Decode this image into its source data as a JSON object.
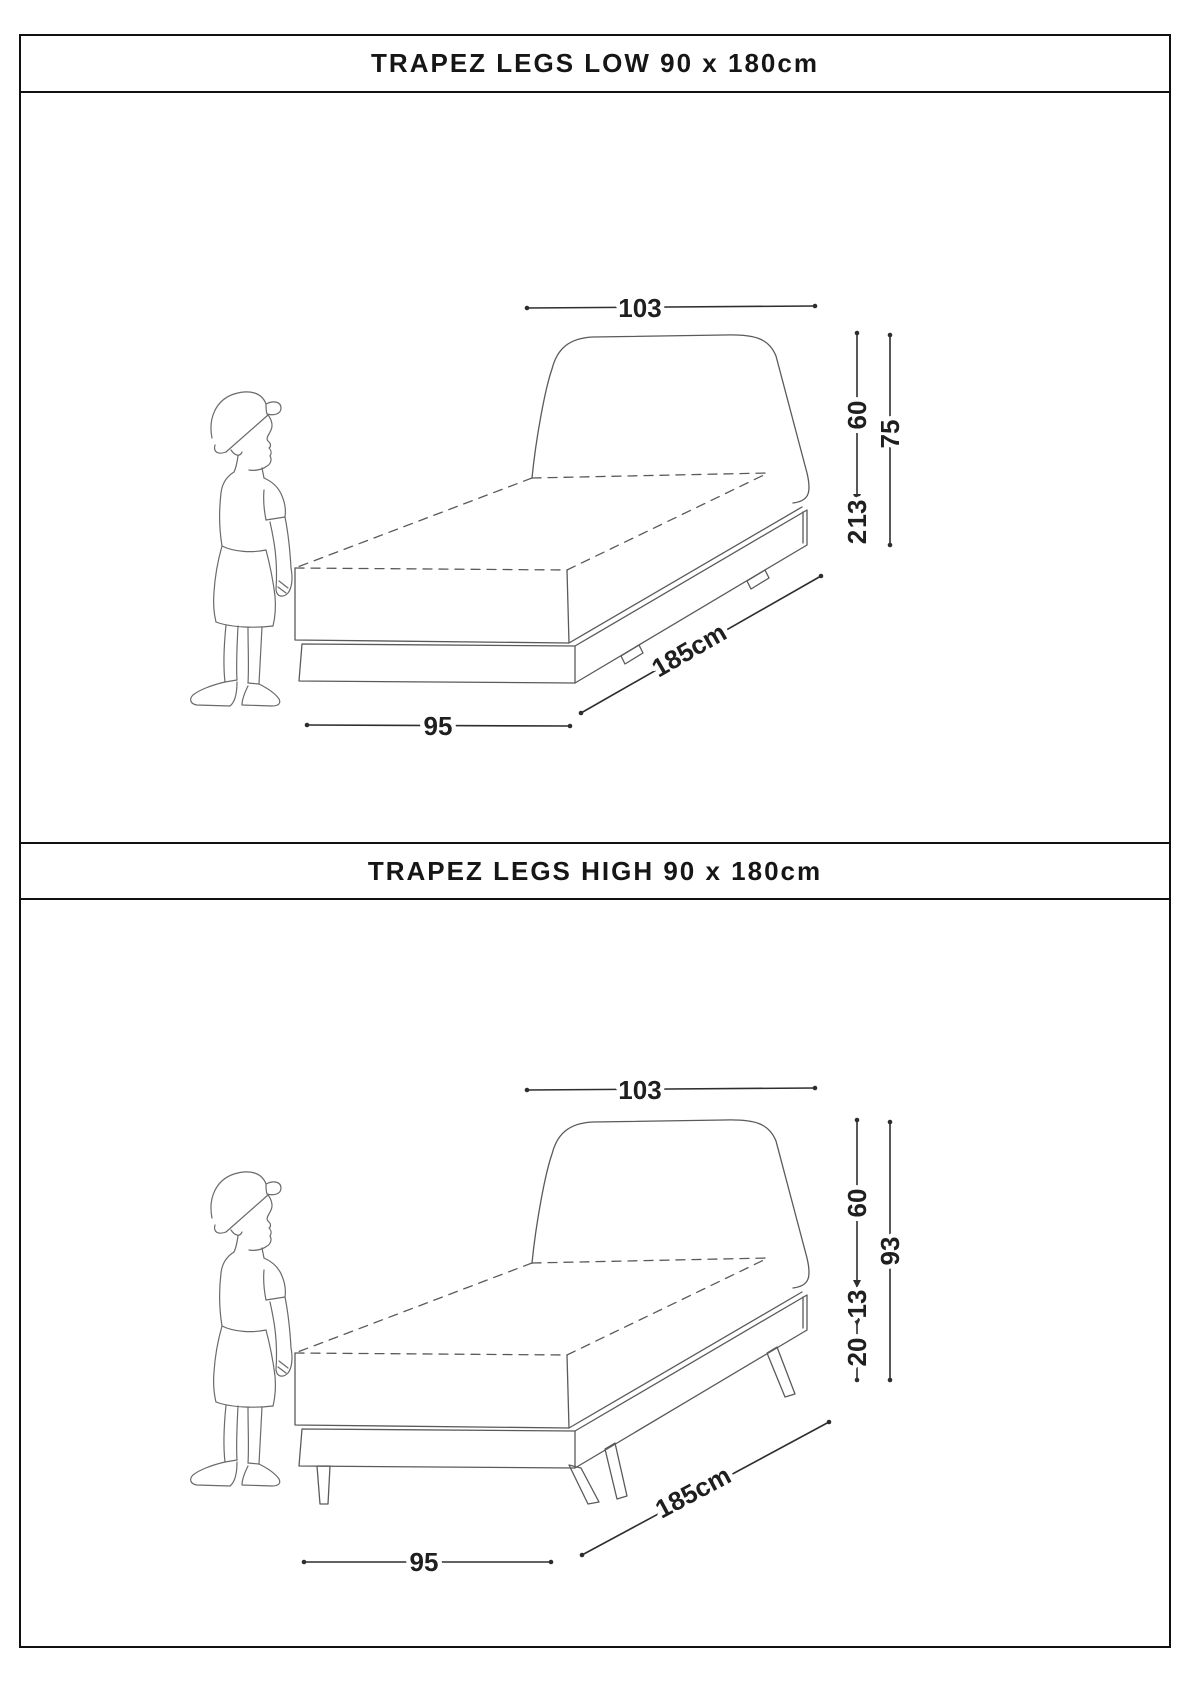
{
  "panels": [
    {
      "title": "TRAPEZ LEGS LOW 90 x 180cm",
      "dims": {
        "headboard_width": "103",
        "headboard_above_mattress": "60",
        "total_height": "75",
        "frame_height": "13",
        "floor_clearance": "2",
        "length": "185cm",
        "front_width": "95"
      }
    },
    {
      "title": "TRAPEZ LEGS HIGH 90 x 180cm",
      "dims": {
        "headboard_width": "103",
        "headboard_above_mattress": "60",
        "total_height": "93",
        "frame_height": "13",
        "floor_clearance": "20",
        "length": "185cm",
        "front_width": "95"
      }
    }
  ]
}
